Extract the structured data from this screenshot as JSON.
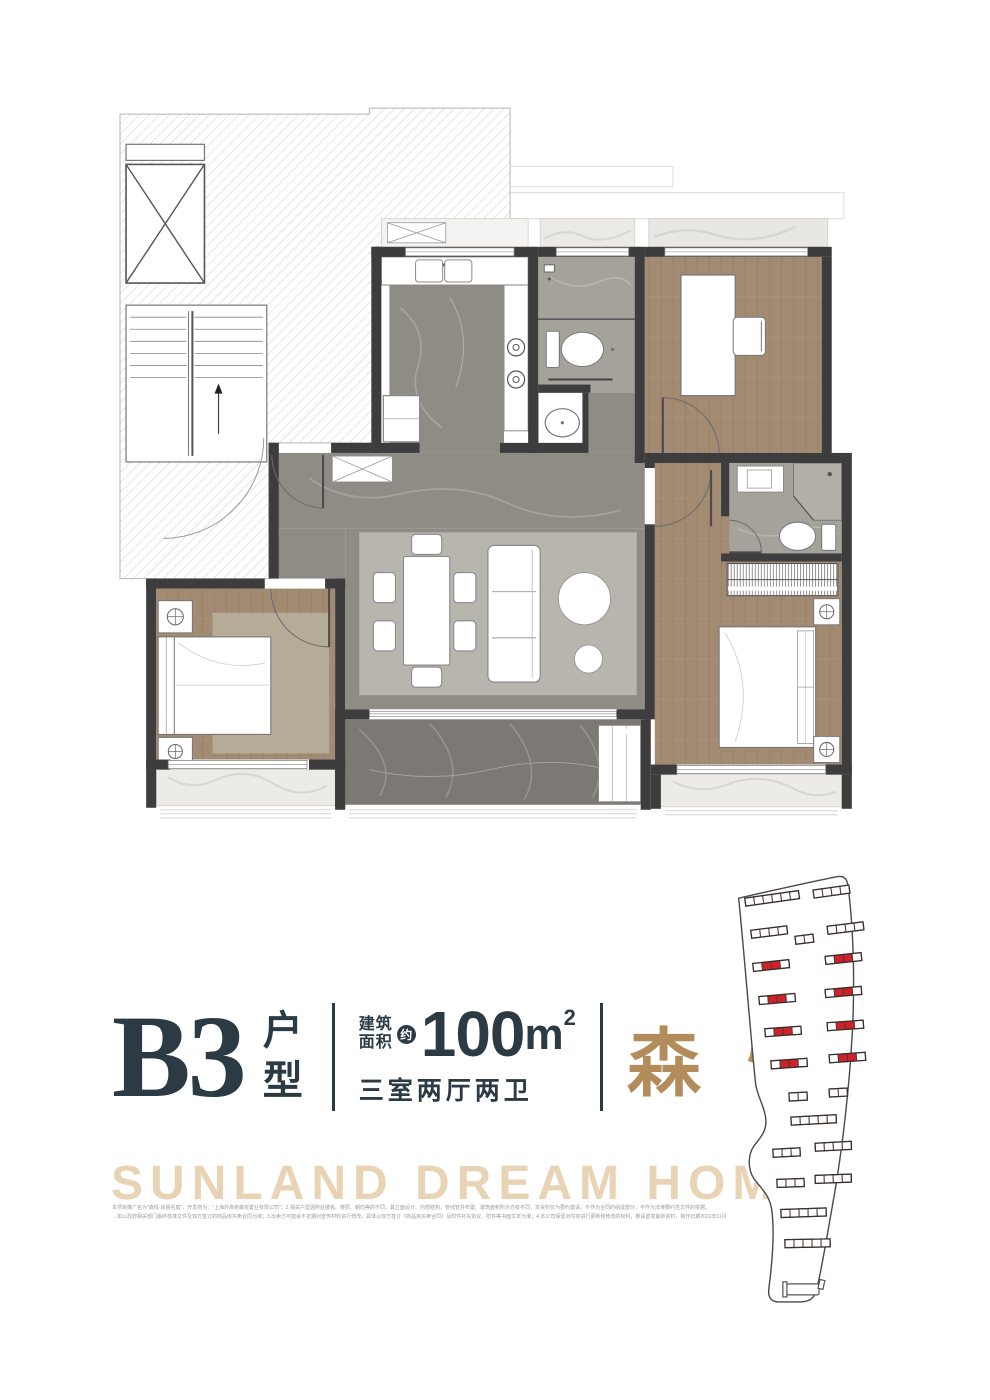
{
  "title_block": {
    "unit_code": "B3",
    "unit_suffix": "户型",
    "area_label_line1": "建筑",
    "area_label_line2": "面积",
    "approx_badge": "约",
    "area_value": "100",
    "area_unit": "m",
    "area_exponent": "2",
    "layout_text": "三室两厅两卫",
    "project_name": "森悦"
  },
  "slogan": "SUNLAND DREAM HOME",
  "disclaimer": {
    "line1": "本项目推广名为\"森悦·启晨名庭\"，开发商为：\"上海外高桥森悦置业有限公司\"；2.相关户型因所处楼栋、楼层、朝向等的不同，其立面设计、内部结构、管线管井布置、建筑面积所示亦有不同，本资料仅为要约邀请，不作为合同的组成部分，不作为法律要约性文件的依据。",
    "line2": "→如以政府相关部门最终核准文件及双方签订的商品房买卖合同为准；3.出卖方可能会不定期对宣传材料进行修改，具体以双方签订《商品房买卖合同》及附件补充协议、附件等书面文本为准；4.本公司保留对内容进行更新和修改的权利，敬请留意最新资料，制作日期2022年11月"
  },
  "colors": {
    "ink": "#2b3a43",
    "gold": "#b28d5b",
    "slogan_tan": "#e8d4b5",
    "highlight_red": "#cf2127",
    "wall_dark": "#3d3d3d",
    "wood_floor": "#a38b73",
    "marble_gray": "#8f8c86",
    "marble_dark": "#7c7975",
    "disclaimer_gray": "#9b9b9b"
  },
  "site_plan": {
    "highlight_color": "#cf2127",
    "buildings": [
      {
        "x": 20,
        "y": 30,
        "segs": 6,
        "rot": -8,
        "red": []
      },
      {
        "x": 88,
        "y": 22,
        "segs": 4,
        "rot": -8,
        "red": []
      },
      {
        "x": 26,
        "y": 62,
        "segs": 4,
        "rot": -7,
        "red": []
      },
      {
        "x": 70,
        "y": 68,
        "segs": 2,
        "rot": -7,
        "red": []
      },
      {
        "x": 102,
        "y": 58,
        "segs": 4,
        "rot": -7,
        "red": []
      },
      {
        "x": 28,
        "y": 95,
        "segs": 4,
        "rot": -6,
        "red": [
          1,
          2
        ]
      },
      {
        "x": 100,
        "y": 88,
        "segs": 4,
        "rot": -6,
        "red": [
          1,
          2
        ]
      },
      {
        "x": 34,
        "y": 128,
        "segs": 4,
        "rot": -5,
        "red": [
          1,
          2
        ]
      },
      {
        "x": 100,
        "y": 121,
        "segs": 4,
        "rot": -5,
        "red": [
          1,
          2
        ]
      },
      {
        "x": 40,
        "y": 160,
        "segs": 4,
        "rot": -4,
        "red": [
          1,
          2
        ]
      },
      {
        "x": 102,
        "y": 154,
        "segs": 4,
        "rot": -4,
        "red": [
          1,
          2
        ]
      },
      {
        "x": 46,
        "y": 192,
        "segs": 4,
        "rot": -4,
        "red": [
          1,
          2
        ]
      },
      {
        "x": 104,
        "y": 186,
        "segs": 4,
        "rot": -4,
        "red": [
          1,
          2
        ]
      },
      {
        "x": 64,
        "y": 224,
        "segs": 2,
        "rot": -3,
        "red": []
      },
      {
        "x": 104,
        "y": 220,
        "segs": 2,
        "rot": -3,
        "red": []
      },
      {
        "x": 66,
        "y": 248,
        "segs": 5,
        "rot": -3,
        "red": []
      },
      {
        "x": 48,
        "y": 280,
        "segs": 3,
        "rot": -3,
        "red": []
      },
      {
        "x": 90,
        "y": 274,
        "segs": 4,
        "rot": -3,
        "red": []
      },
      {
        "x": 52,
        "y": 310,
        "segs": 3,
        "rot": -2,
        "red": []
      },
      {
        "x": 90,
        "y": 306,
        "segs": 4,
        "rot": -2,
        "red": []
      },
      {
        "x": 56,
        "y": 340,
        "segs": 5,
        "rot": -2,
        "red": []
      },
      {
        "x": 60,
        "y": 370,
        "segs": 5,
        "rot": -1,
        "red": []
      }
    ]
  }
}
